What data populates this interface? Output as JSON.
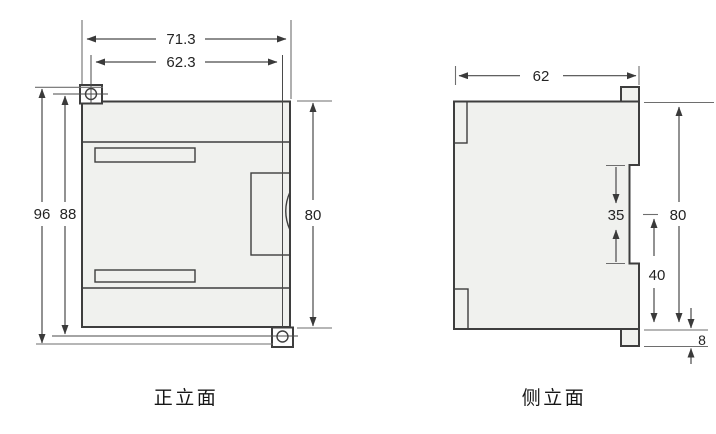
{
  "drawing": {
    "front_view": {
      "caption": "正立面",
      "dims": {
        "overall_width": "71.3",
        "screw_spacing_width": "62.3",
        "overall_height": "96",
        "screw_spacing_height": "88",
        "body_height": "80"
      }
    },
    "side_view": {
      "caption": "侧立面",
      "dims": {
        "depth": "62",
        "din_rail_notch": "35",
        "body_height": "80",
        "lower_section": "40",
        "tab_protrusion": "8"
      }
    },
    "colors": {
      "body_fill": "#f0f1ee",
      "white_fill": "#fdfdfd",
      "line": "#3e3e3e"
    }
  }
}
